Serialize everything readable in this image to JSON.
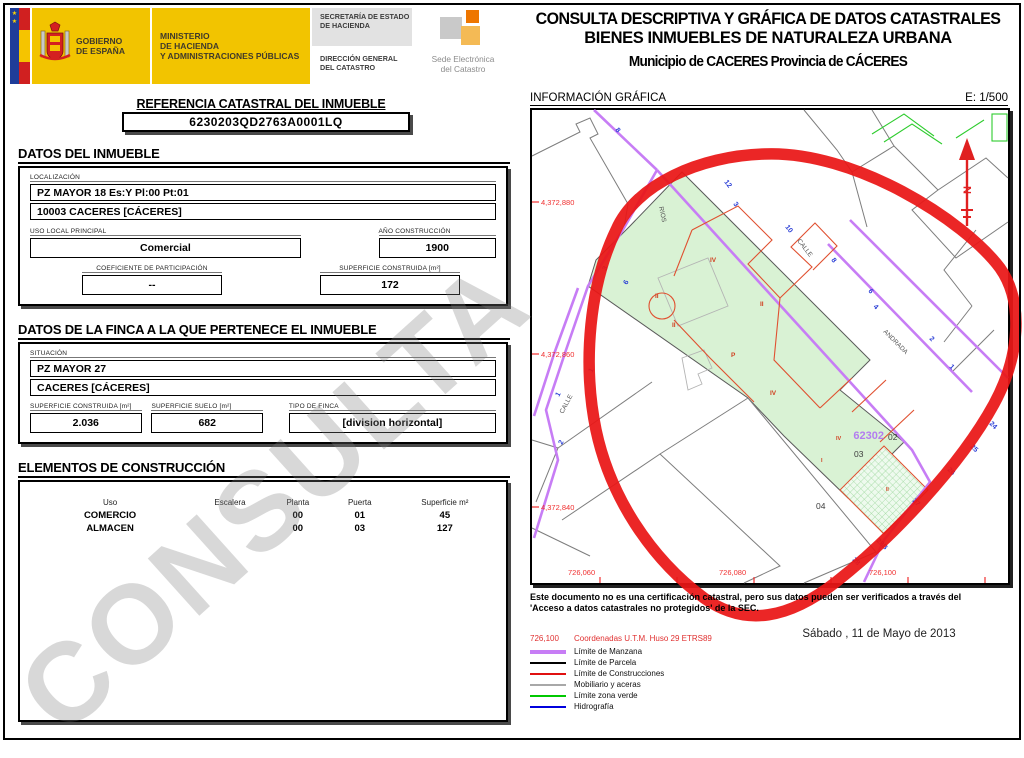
{
  "header": {
    "gobierno_line1": "GOBIERNO",
    "gobierno_line2": "DE ESPAÑA",
    "ministerio_line1": "MINISTERIO",
    "ministerio_line2": "DE HACIENDA",
    "ministerio_line3": "Y ADMINISTRACIONES PÚBLICAS",
    "secretaria_line1": "SECRETARÍA DE ESTADO",
    "secretaria_line2": "DE HACIENDA",
    "direccion_line1": "DIRECCIÓN GENERAL",
    "direccion_line2": "DEL CATASTRO",
    "sede_line1": "Sede Electrónica",
    "sede_line2": "del Catastro"
  },
  "title": {
    "line1": "CONSULTA DESCRIPTIVA Y GRÁFICA DE DATOS CATASTRALES",
    "line2": "BIENES INMUEBLES DE NATURALEZA URBANA",
    "municipio": "Municipio de CACERES Provincia de CÁCERES"
  },
  "referencia": {
    "label": "REFERENCIA CATASTRAL DEL INMUEBLE",
    "value": "6230203QD2763A0001LQ"
  },
  "datos_inmueble": {
    "section_title": "DATOS DEL INMUEBLE",
    "localizacion_label": "LOCALIZACIÓN",
    "localizacion_line1": "PZ MAYOR 18 Es:Y Pl:00 Pt:01",
    "localizacion_line2": "10003 CACERES [CÁCERES]",
    "uso_label": "USO LOCAL PRINCIPAL",
    "uso_value": "Comercial",
    "anio_label": "AÑO CONSTRUCCIÓN",
    "anio_value": "1900",
    "coef_label": "COEFICIENTE DE PARTICIPACIÓN",
    "coef_value": "--",
    "sup_label": "SUPERFICIE CONSTRUIDA [m²]",
    "sup_value": "172"
  },
  "datos_finca": {
    "section_title": "DATOS DE LA FINCA A LA QUE PERTENECE EL INMUEBLE",
    "situacion_label": "SITUACIÓN",
    "situacion_line1": "PZ MAYOR 27",
    "situacion_line2": "CACERES [CÁCERES]",
    "sup_construida_label": "SUPERFICIE CONSTRUIDA [m²]",
    "sup_construida_value": "2.036",
    "sup_suelo_label": "SUPERFICIE SUELO [m²]",
    "sup_suelo_value": "682",
    "tipo_label": "TIPO DE FINCA",
    "tipo_value": "[division horizontal]"
  },
  "elementos": {
    "section_title": "ELEMENTOS DE CONSTRUCCIÓN",
    "headers": [
      "Uso",
      "Escalera",
      "Planta",
      "Puerta",
      "Superficie m²"
    ],
    "rows": [
      [
        "COMERCIO",
        "",
        "00",
        "01",
        "45"
      ],
      [
        "ALMACEN",
        "",
        "00",
        "03",
        "127"
      ]
    ]
  },
  "watermark": "CONSULTA",
  "map": {
    "info_label": "INFORMACIÓN GRÁFICA",
    "scale": "E: 1/500",
    "north_label": "N",
    "manzana_number": "62302",
    "parcel_numbers": [
      "02",
      "03",
      "04"
    ],
    "roman_labels": [
      "IV",
      "II",
      "II",
      "II",
      "P",
      "IV",
      "IV",
      "I",
      "II"
    ],
    "street_names": [
      "CALLE",
      "RIOS",
      "CALLE",
      "ANDRADA"
    ],
    "house_numbers": [
      "8",
      "12",
      "3",
      "10",
      "8",
      "6",
      "3",
      "6",
      "1",
      "1",
      "2",
      "4",
      "2",
      "1",
      "24",
      "25",
      "26",
      "27",
      "28B",
      "28"
    ],
    "coords_left": [
      "4,372,880",
      "4,372,860",
      "4,372,840"
    ],
    "coords_bottom": [
      "726,060",
      "726,080",
      "726,100"
    ]
  },
  "footer": {
    "note_line1": "Este documento no es una certificación catastral, pero sus datos pueden ser verificados a través del",
    "note_line2": "'Acceso a datos catastrales no protegidos' de la SEC.",
    "date": "Sábado , 11 de Mayo de 2013"
  },
  "legend": {
    "coord_sample": "726,100",
    "coord_label": "Coordenadas U.T.M. Huso 29 ETRS89",
    "items": [
      {
        "label": "Límite de Manzana",
        "color": "#c77df5"
      },
      {
        "label": "Límite de Parcela",
        "color": "#000000"
      },
      {
        "label": "Límite de Construcciones",
        "color": "#e01010"
      },
      {
        "label": "Mobiliario y aceras",
        "color": "#a8a8a8"
      },
      {
        "label": "Límite zona verde",
        "color": "#00c800"
      },
      {
        "label": "Hidrografía",
        "color": "#0000dd"
      }
    ]
  },
  "colors": {
    "header_yellow": "#f2c400",
    "selected_parcel_fill": "#d9f2d4",
    "annotation_circle": "#ea1515",
    "manzana_line": "#c77df5",
    "construction_line": "#e05030",
    "house_number_blue": "#2b3fd6",
    "coordinate_red": "#f03030"
  }
}
